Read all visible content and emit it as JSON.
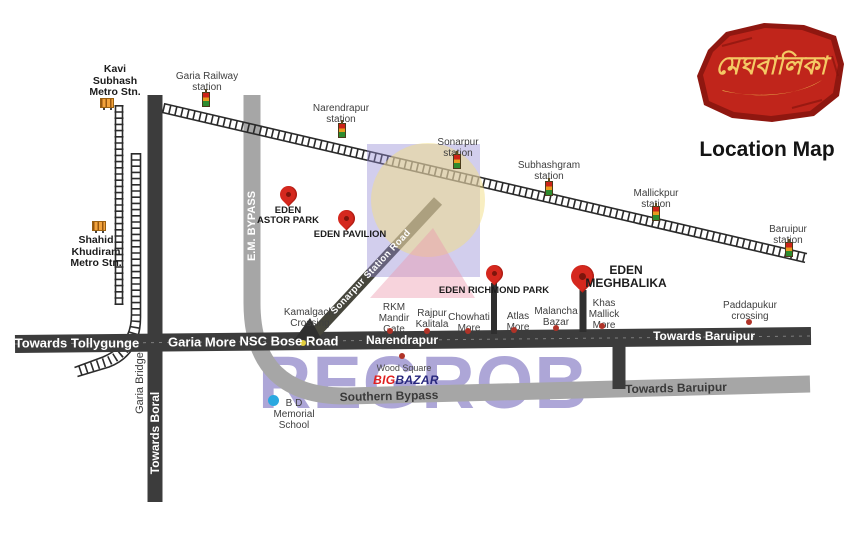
{
  "logo": {
    "brand_text": "মেঘবালিকা",
    "caption": "Location Map"
  },
  "watermark": {
    "text": "REGROB"
  },
  "metro_stations": [
    {
      "name": "Kavi\nSubhash\nMetro Stn."
    },
    {
      "name": "Shahid\nKhudiram\nMetro Stn."
    }
  ],
  "railway_stations": [
    {
      "name": "Garia Railway\nstation"
    },
    {
      "name": "Narendrapur\nstation"
    },
    {
      "name": "Sonarpur\nstation"
    },
    {
      "name": "Subhashgram\nstation"
    },
    {
      "name": "Mallickpur\nstation"
    },
    {
      "name": "Baruipur\nstation"
    }
  ],
  "projects": [
    {
      "name": "EDEN\nASTOR PARK"
    },
    {
      "name": "EDEN PAVILION"
    },
    {
      "name": "EDEN RICHMOND PARK"
    },
    {
      "name": "EDEN\nMEGHBALIKA"
    }
  ],
  "pois": [
    {
      "name": "Kamalgachi\nCrossing"
    },
    {
      "name": "RKM\nMandir\nGate"
    },
    {
      "name": "Rajpur\nKalitala"
    },
    {
      "name": "Chowhati\nMore"
    },
    {
      "name": "Atlas\nMore"
    },
    {
      "name": "Malancha\nBazar"
    },
    {
      "name": "Khas\nMallick\nMore"
    },
    {
      "name": "Paddapukur\ncrossing"
    }
  ],
  "landmarks": {
    "wood_square": "Wood Square",
    "bigbazar_big": "BIG",
    "bigbazar_bazar": "BAZAR",
    "bd_school": "B D\nMemorial\nSchool"
  },
  "roads": {
    "towards_tollygunge": "Towards Tollygunge",
    "garia_more": "Garia More",
    "nsc_bose": "NSC Bose Road",
    "narendrapur": "Narendrapur",
    "towards_baruipur_main": "Towards Baruipur",
    "em_bypass": "E.M. BYPASS",
    "sonarpur_station_road": "Sonarpur Station Road",
    "southern_bypass": "Southern Bypass",
    "towards_baruipur_bypass": "Towards Baruipur",
    "towards_boral": "Towards Boral",
    "garia_bridge": "Garia Bridge"
  },
  "colors": {
    "pin_red": "#d5281e",
    "road_dark": "#3c3c3c",
    "road_gray": "#a6a6a6",
    "watermark_purple": "#7b6fbe",
    "logo_red": "#b11b12",
    "logo_gold": "#f4c964",
    "bigbazar_red": "#e02020",
    "bigbazar_blue": "#28287e"
  }
}
